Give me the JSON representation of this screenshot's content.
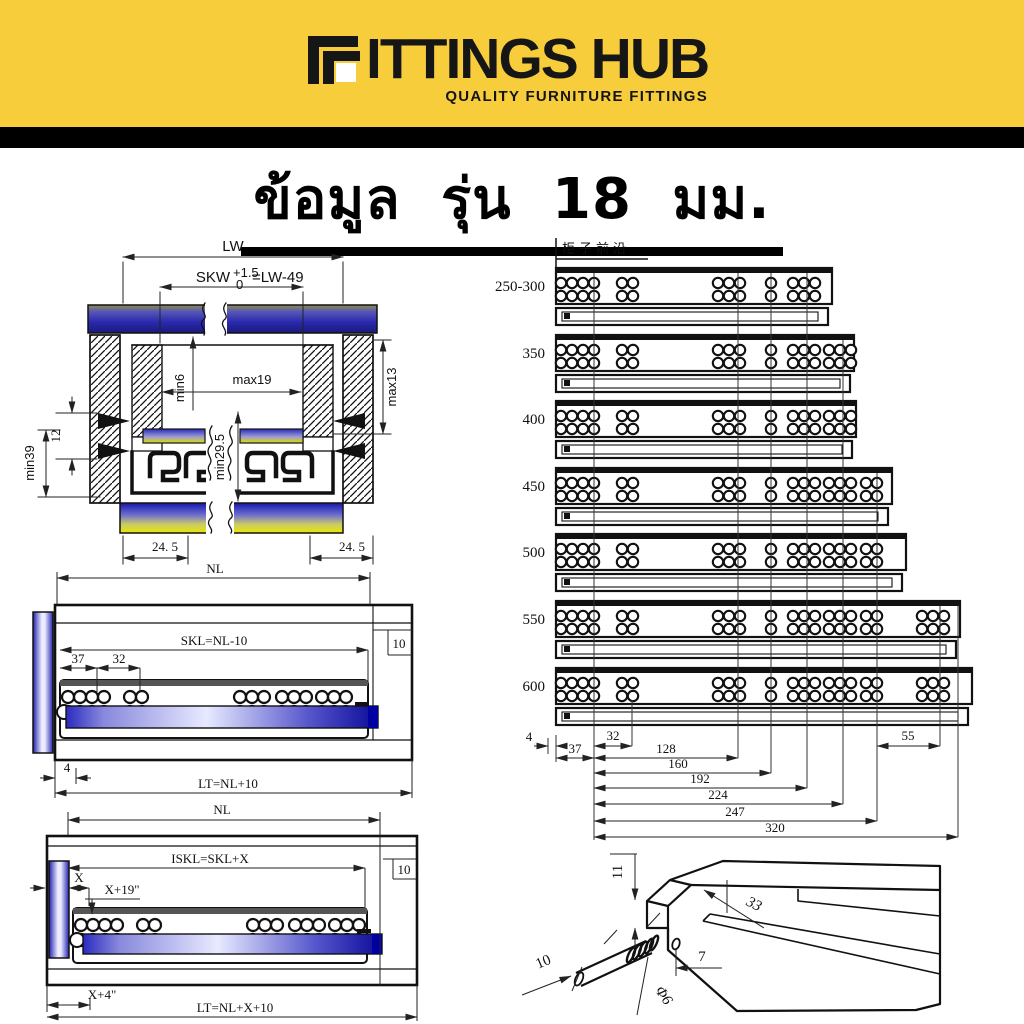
{
  "logo": {
    "brand": "FITTINGS HUB",
    "text_after_icon": "ITTINGS HUB",
    "tagline": "QUALITY FURNITURE FITTINGS"
  },
  "title": {
    "text": "ข้อมูล รุ่น 18 มม."
  },
  "cross_section": {
    "lw": "LW",
    "skw": "SKW",
    "skw_tol_plus": "+1.5",
    "skw_tol_zero": "0",
    "skw_eq": "=LW-49",
    "min6": "min6",
    "max19": "max19",
    "max13": "max13",
    "d12": "12",
    "min39": "min39",
    "min29_5": "min29.5",
    "d24_5_left": "24. 5",
    "d24_5_right": "24. 5"
  },
  "side_view": {
    "nl": "NL",
    "skl": "SKL=NL-10",
    "d37": "37",
    "d32": "32",
    "d10": "10",
    "d4": "4",
    "lt": "LT=NL+10"
  },
  "inset_view": {
    "nl": "NL",
    "iskl": "ISKL=SKL+X",
    "x": "X",
    "x_plus_19": "X+19\"",
    "d10": "10",
    "x_plus_4": "X+4\"",
    "lt": "LT=NL+X+10"
  },
  "length_chart": {
    "cabinet_front_edge": "柜子前沿",
    "rows": [
      {
        "label": "250-300"
      },
      {
        "label": "350"
      },
      {
        "label": "400"
      },
      {
        "label": "450"
      },
      {
        "label": "500"
      },
      {
        "label": "550"
      },
      {
        "label": "600"
      }
    ],
    "dims": {
      "d4": "4",
      "d37": "37",
      "d32": "32",
      "d128": "128",
      "d160": "160",
      "d192": "192",
      "d224": "224",
      "d247": "247",
      "d320": "320",
      "d55": "55"
    }
  },
  "pin_detail": {
    "d11": "11",
    "d33": "33",
    "d7": "7",
    "d10": "10",
    "phi6": "Φ6"
  }
}
